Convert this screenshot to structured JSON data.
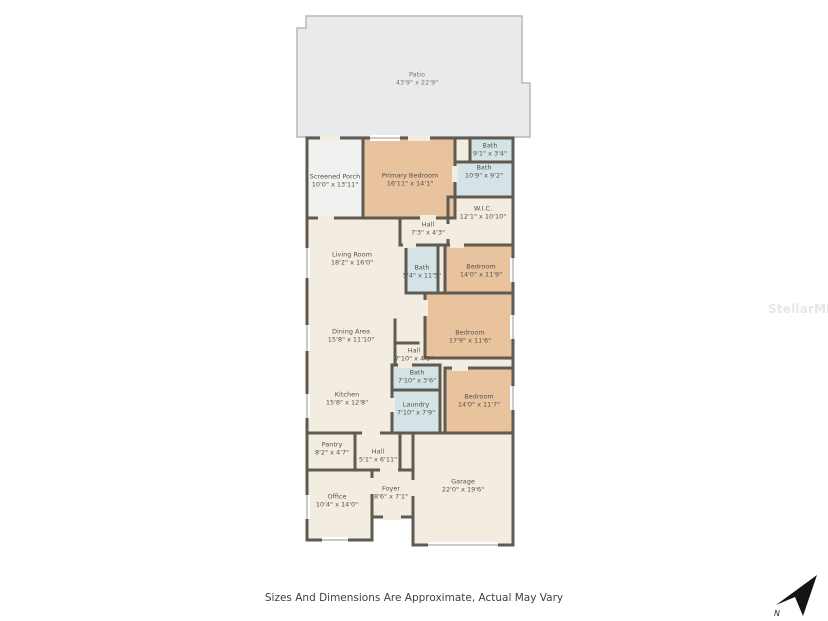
{
  "page": {
    "disclaimer": "Sizes And Dimensions Are Approximate, Actual May Vary",
    "watermark": "StellarMLS",
    "compass_label": "N"
  },
  "colors": {
    "wall": "#5f5a52",
    "bedroom_fill": "#e9c29e",
    "bath_fill": "#d4e4e6",
    "living_fill": "#f3ede1",
    "porch_fill": "#f1f1f0",
    "patio_fill": "#e9eaeb",
    "patio_stroke": "#b6b9bc"
  },
  "rooms": [
    {
      "name": "Patio",
      "dims": "43'9\" x 22'9\""
    },
    {
      "name": "Screened Porch",
      "dims": "10'0\" x 13'11\""
    },
    {
      "name": "Primary Bedroom",
      "dims": "16'11\" x 14'1\""
    },
    {
      "name": "Bath",
      "dims": "9'1\" x 3'4\""
    },
    {
      "name": "Bath",
      "dims": "10'9\" x 9'2\""
    },
    {
      "name": "W.I.C.",
      "dims": "12'1\" x 10'10\""
    },
    {
      "name": "Hall",
      "dims": "7'3\" x 4'3\""
    },
    {
      "name": "Living Room",
      "dims": "18'2\" x 16'0\""
    },
    {
      "name": "Bath",
      "dims": "5'4\" x 11'5\""
    },
    {
      "name": "Bedroom",
      "dims": "14'0\" x 11'9\""
    },
    {
      "name": "Dining Area",
      "dims": "15'8\" x 11'10\""
    },
    {
      "name": "Bedroom",
      "dims": "17'9\" x 11'6\""
    },
    {
      "name": "Hall",
      "dims": "7'10\" x 4'3\""
    },
    {
      "name": "Bath",
      "dims": "7'10\" x 3'6\""
    },
    {
      "name": "Laundry",
      "dims": "7'10\" x 7'9\""
    },
    {
      "name": "Kitchen",
      "dims": "15'8\" x 12'8\""
    },
    {
      "name": "Bedroom",
      "dims": "14'0\" x 11'7\""
    },
    {
      "name": "Pantry",
      "dims": "8'2\" x 4'7\""
    },
    {
      "name": "Hall",
      "dims": "5'1\" x 6'11\""
    },
    {
      "name": "Office",
      "dims": "10'4\" x 14'0\""
    },
    {
      "name": "Foyer",
      "dims": "8'6\" x 7'1\""
    },
    {
      "name": "Garage",
      "dims": "22'0\" x 19'6\""
    }
  ]
}
